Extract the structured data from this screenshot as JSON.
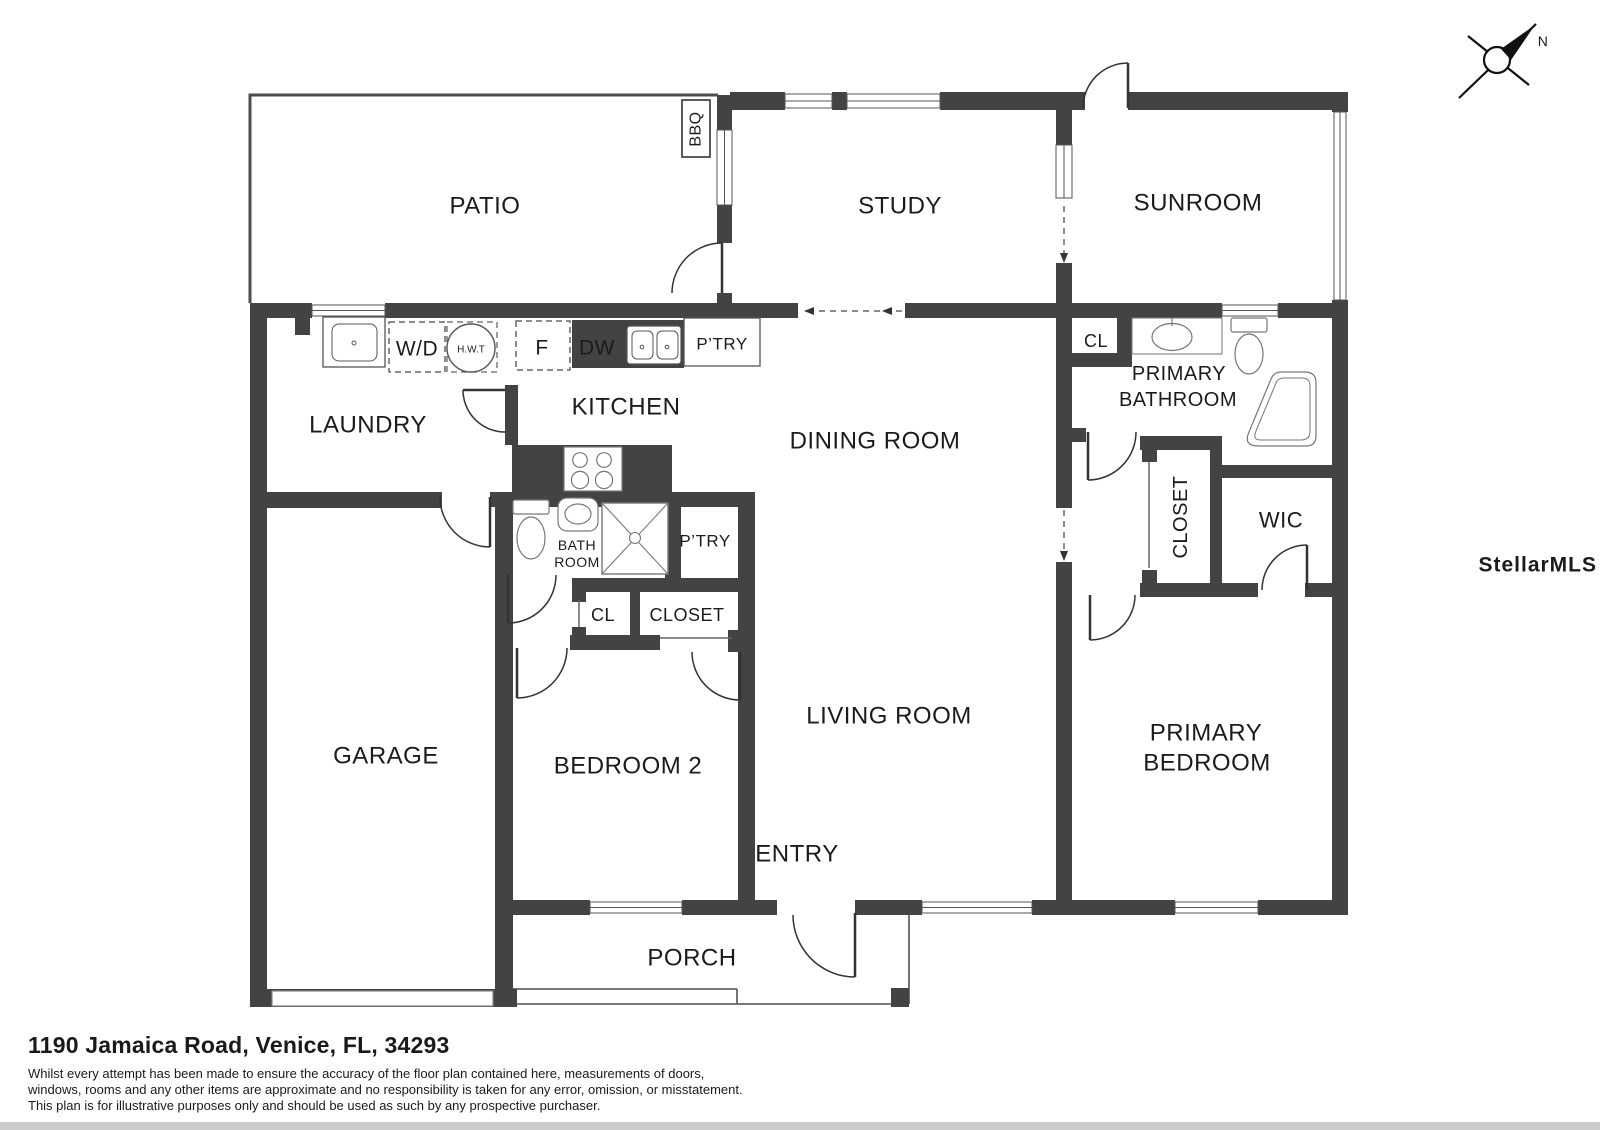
{
  "plan": {
    "rooms": {
      "patio": "PATIO",
      "study": "STUDY",
      "sunroom": "SUNROOM",
      "laundry": "LAUNDRY",
      "kitchen": "KITCHEN",
      "dining": "DINING ROOM",
      "garage": "GARAGE",
      "bedroom2": "BEDROOM 2",
      "living": "LIVING ROOM",
      "entry": "ENTRY",
      "porch": "PORCH",
      "primary_bedroom_line1": "PRIMARY",
      "primary_bedroom_line2": "BEDROOM",
      "primary_bath_line1": "PRIMARY",
      "primary_bath_line2": "BATHROOM",
      "wic": "WIC",
      "closet_primary": "CLOSET",
      "closet_hall": "CLOSET",
      "cl_hall": "CL",
      "cl_bath": "CL",
      "bath_line1": "BATH",
      "bath_line2": "ROOM",
      "pantry_kitchen": "P’TRY",
      "pantry_hall": "P’TRY"
    },
    "fixtures": {
      "washer_dryer": "W/D",
      "hot_water_tank": "H.W.T",
      "fridge": "F",
      "dishwasher": "DW",
      "bbq": "BBQ"
    },
    "annotations": {
      "north": "N",
      "watermark": "StellarMLS"
    }
  },
  "footer": {
    "address": "1190 Jamaica Road, Venice, FL, 34293",
    "disclaimer": [
      "Whilst every attempt has been made to ensure the accuracy of the floor plan contained here, measurements of doors,",
      "windows, rooms and any other items are approximate and no responsibility is taken for any error, omission, or misstatement.",
      "This plan is for illustrative purposes only and should be used as such by any prospective purchaser."
    ]
  },
  "colors": {
    "wall": "#434343",
    "thin_line": "#555555",
    "watermark": "#e3e3e3"
  }
}
